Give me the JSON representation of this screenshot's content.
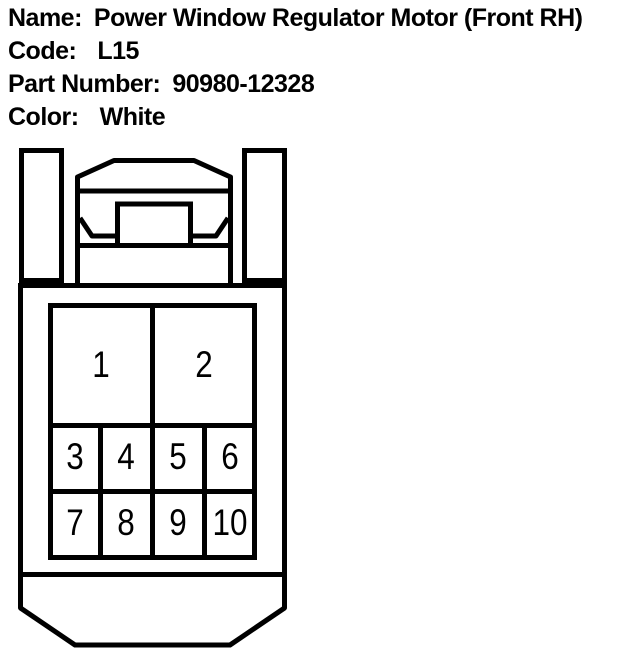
{
  "header": {
    "lines": [
      {
        "label": "Name:",
        "value": "Power Window Regulator Motor (Front RH)"
      },
      {
        "label": "Code:",
        "value": "L15"
      },
      {
        "label": "Part Number:",
        "value": "90980-12328"
      },
      {
        "label": "Color:",
        "value": "White"
      }
    ]
  },
  "connector": {
    "pins": [
      "1",
      "2",
      "3",
      "4",
      "5",
      "6",
      "7",
      "8",
      "9",
      "10"
    ],
    "line_color": "#000000",
    "background_color": "#ffffff"
  }
}
